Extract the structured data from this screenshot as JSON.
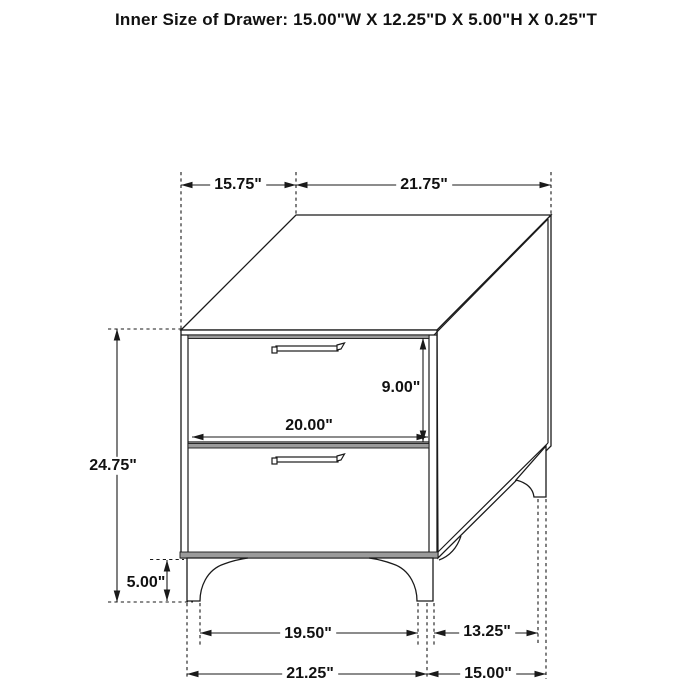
{
  "title": "Inner Size of Drawer: 15.00\"W X 12.25\"D X 5.00\"H X 0.25\"T",
  "dimensions": {
    "top_depth": "15.75\"",
    "top_width": "21.75\"",
    "overall_height": "24.75\"",
    "drawer_opening_height": "9.00\"",
    "drawer_front_width": "20.00\"",
    "leg_height": "5.00\"",
    "front_leg_inner_span": "19.50\"",
    "side_leg_span": "13.25\"",
    "front_base_width": "21.25\"",
    "side_base_depth": "15.00\""
  },
  "colors": {
    "line": "#1a1a1a",
    "shade_band": "#9b9b9b",
    "background": "#ffffff",
    "text": "#111111"
  }
}
